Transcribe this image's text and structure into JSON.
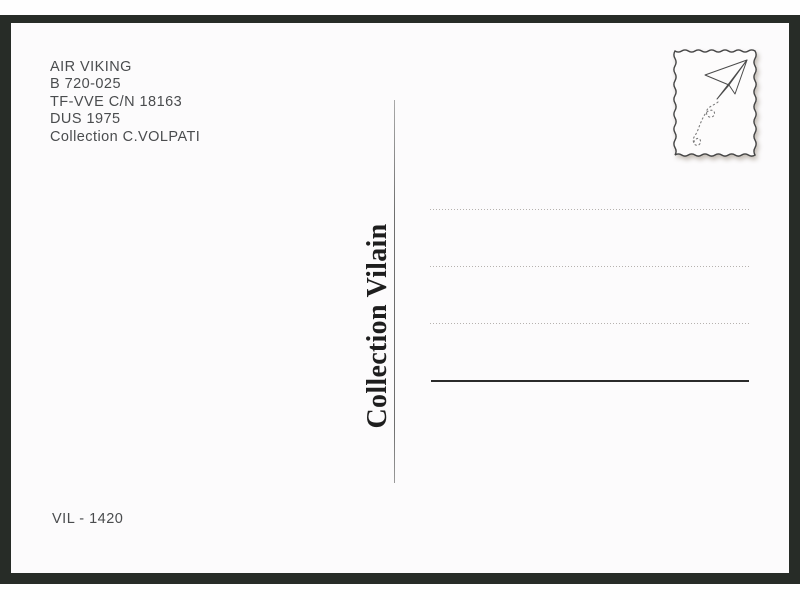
{
  "postcard": {
    "info_lines": [
      "AIR VIKING",
      "B 720-025",
      "TF-VVE C/N 18163",
      "DUS 1975",
      "Collection C.VOLPATI"
    ],
    "divider_label": "Collection Vilain",
    "catalog_number": "VIL - 1420",
    "stamp": {
      "icon": "paper-plane",
      "description": "stamp box with wavy border, paper airplane and dotted flight trail"
    },
    "colors": {
      "frame": "#272c27",
      "card": "#fcfbfc",
      "info_text": "#4a4c4e",
      "divider_text": "#1e1e1e",
      "dotted_line": "#a9a5a1",
      "solid_line": "#2b2b2b"
    }
  }
}
